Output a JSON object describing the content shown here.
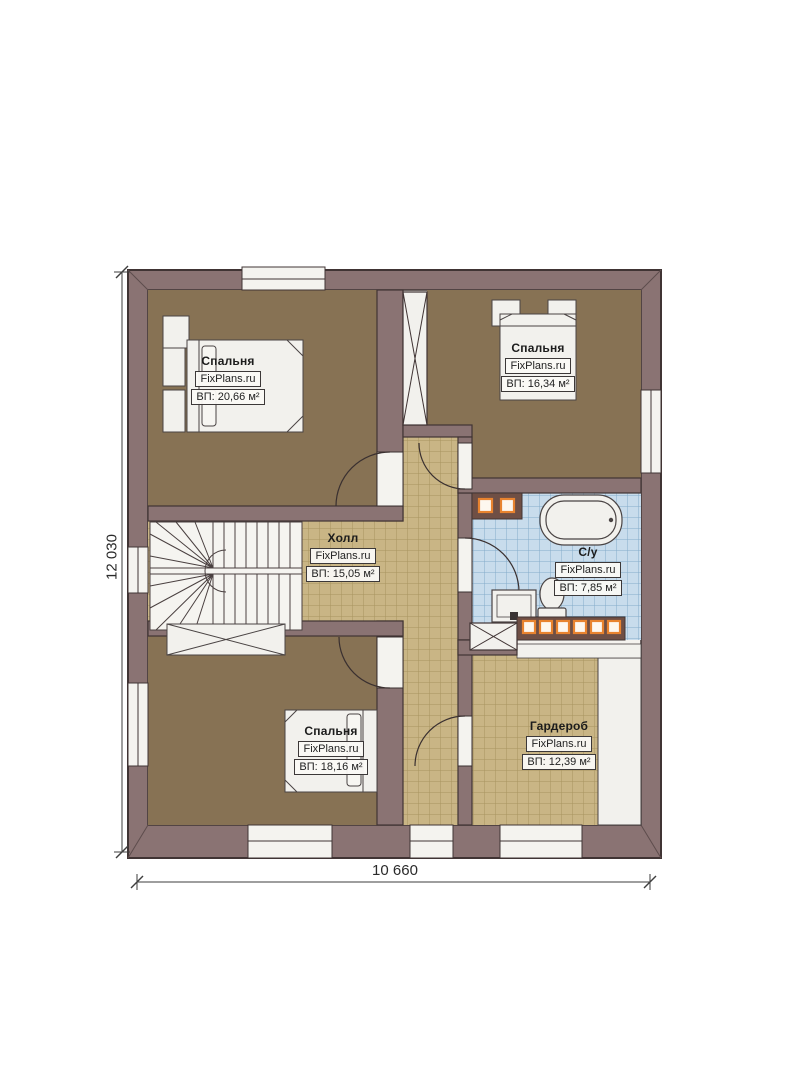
{
  "plan": {
    "title": "floor-plan",
    "dimension_width": "10 660",
    "dimension_height": "12 030"
  },
  "rooms": [
    {
      "key": "bedroom-top-left",
      "name": "Спальня",
      "brand": "FixPlans.ru",
      "area": "ВП: 20,66 м²"
    },
    {
      "key": "bedroom-top-right",
      "name": "Спальня",
      "brand": "FixPlans.ru",
      "area": "ВП: 16,34 м²"
    },
    {
      "key": "hall",
      "name": "Холл",
      "brand": "FixPlans.ru",
      "area": "ВП: 15,05 м²"
    },
    {
      "key": "bathroom",
      "name": "С/у",
      "brand": "FixPlans.ru",
      "area": "ВП: 7,85 м²"
    },
    {
      "key": "bedroom-bottom-left",
      "name": "Спальня",
      "brand": "FixPlans.ru",
      "area": "ВП: 18,16 м²"
    },
    {
      "key": "wardrobe",
      "name": "Гардероб",
      "brand": "FixPlans.ru",
      "area": "ВП: 12,39 м²"
    }
  ],
  "colors": {
    "exterior_wall": "#8a7373",
    "wall_outline": "#403434",
    "bedroom_floor": "#877254",
    "tile_floor": "#c9b585",
    "tile_grid": "#a8945f",
    "bathroom_tile": "#c8dcec",
    "bathroom_grid": "#84abca",
    "fixture_white": "#f2f1ed",
    "accent_orange": "#e8832f",
    "shelf_band": "#6f4f45"
  }
}
